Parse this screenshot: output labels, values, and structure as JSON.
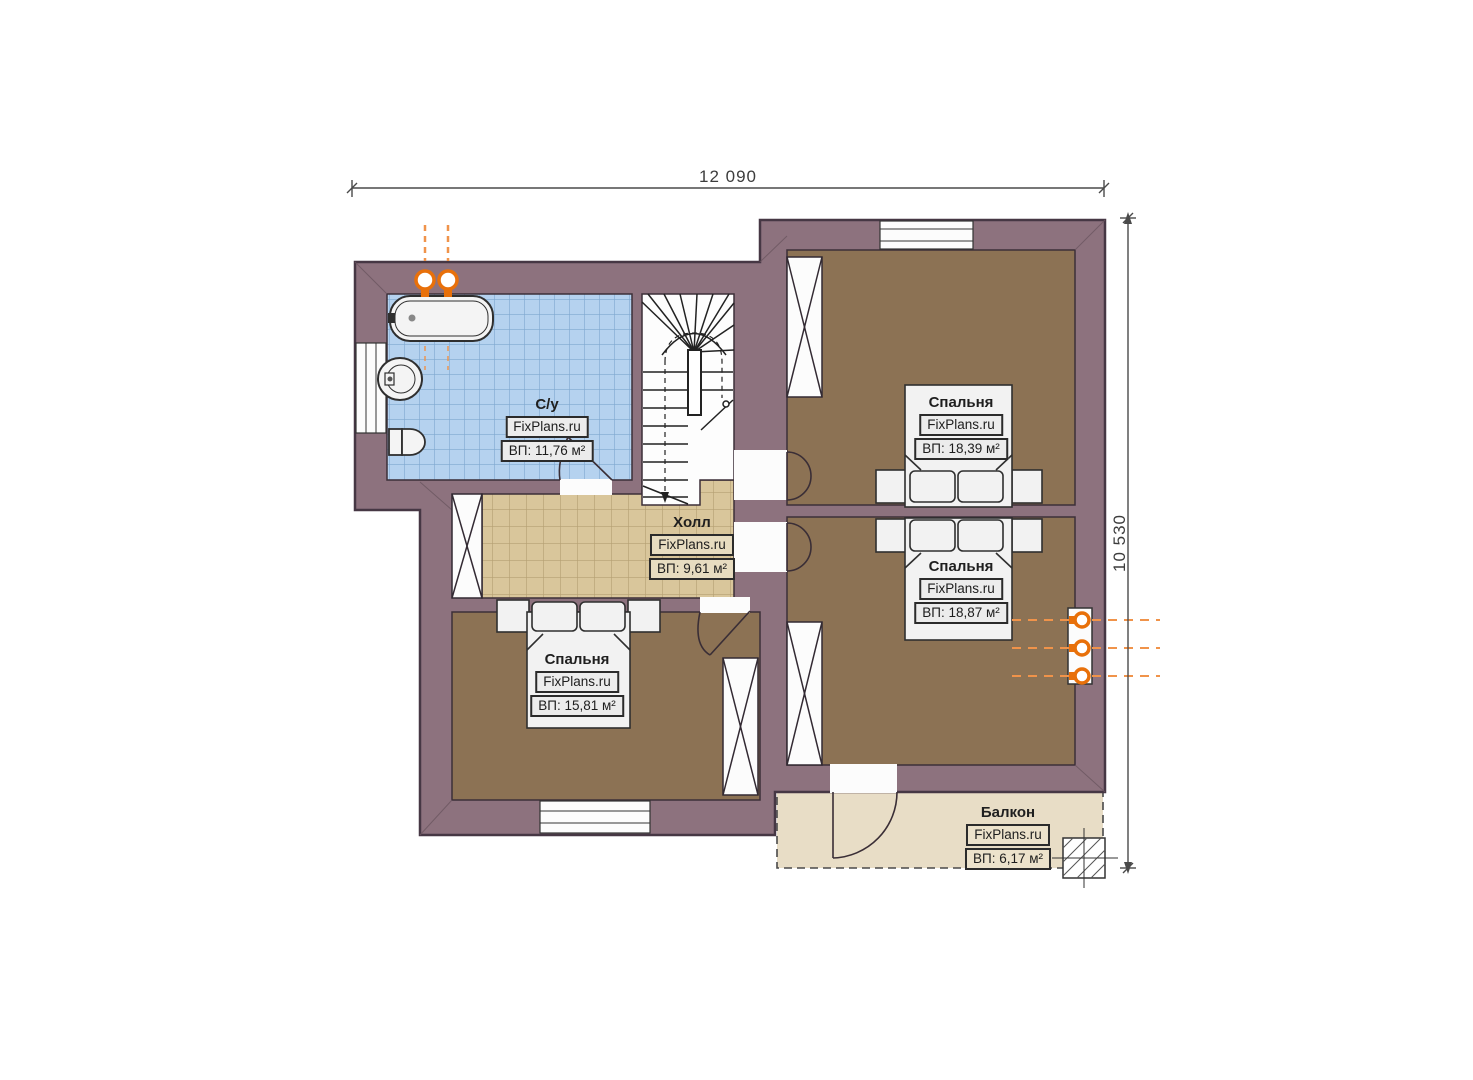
{
  "dimensions": {
    "top": "12 090",
    "right": "10 530"
  },
  "rooms": {
    "bathroom": {
      "name": "С/у",
      "brand": "FixPlans.ru",
      "area": "ВП: 11,76 м²"
    },
    "hall": {
      "name": "Холл",
      "brand": "FixPlans.ru",
      "area": "ВП: 9,61 м²"
    },
    "bedroom_top_right": {
      "name": "Спальня",
      "brand": "FixPlans.ru",
      "area": "ВП: 18,39 м²"
    },
    "bedroom_bottom_right": {
      "name": "Спальня",
      "brand": "FixPlans.ru",
      "area": "ВП: 18,87 м²"
    },
    "bedroom_left": {
      "name": "Спальня",
      "brand": "FixPlans.ru",
      "area": "ВП: 15,81 м²"
    },
    "balcony": {
      "name": "Балкон",
      "brand": "FixPlans.ru",
      "area": "ВП: 6,17 м²"
    }
  },
  "colors": {
    "wall": "#8d727e",
    "wall_outline": "#463744",
    "bathroom_tile": "#b5d2ef",
    "bathroom_tile_line": "#7fa8cf",
    "hall_tile": "#d9c69b",
    "hall_tile_line": "#b49f72",
    "bedroom_floor": "#8c7254",
    "balcony_floor": "#e8ddc6",
    "fixture_fill": "#f2f2f2",
    "outline": "#2f2f2f",
    "pipe_orange": "#e8700a",
    "dimension": "#4a4a4a"
  }
}
